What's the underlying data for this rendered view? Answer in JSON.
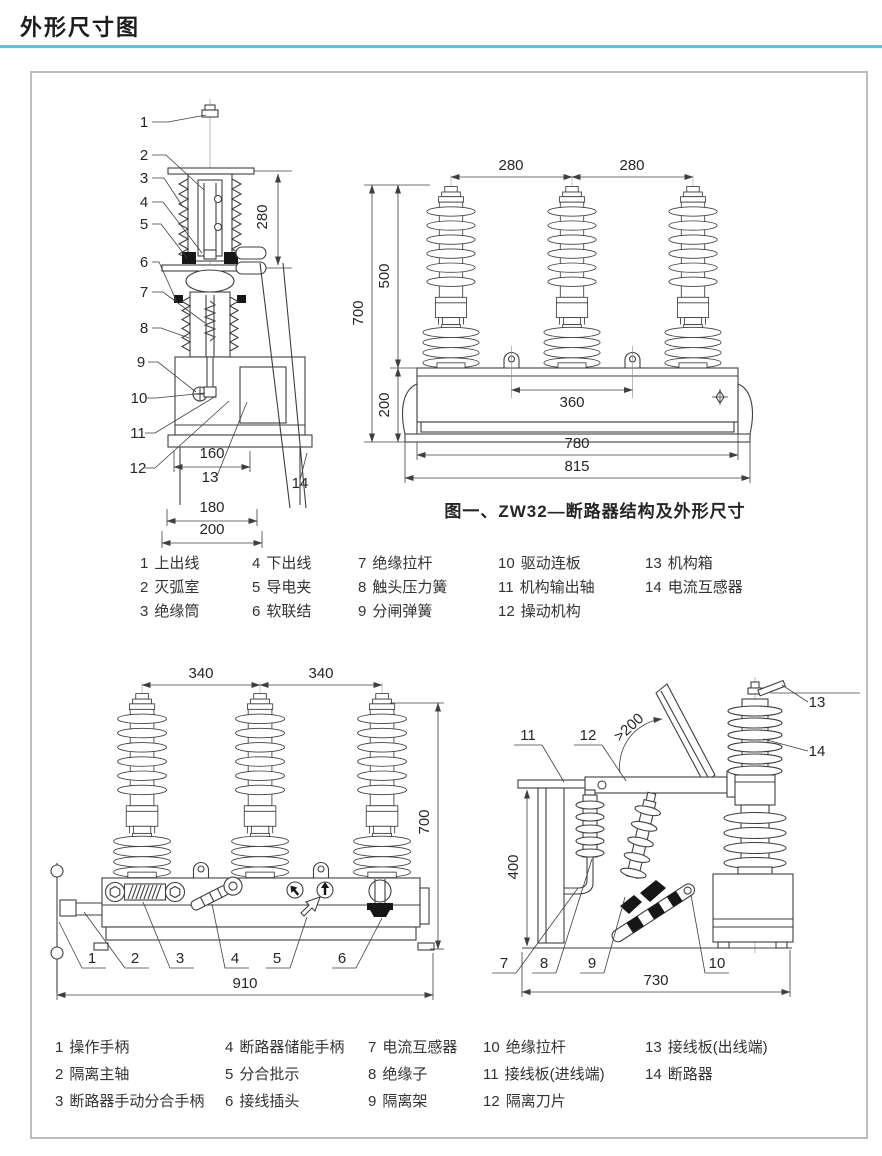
{
  "page": {
    "title": "外形尺寸图"
  },
  "colors": {
    "accent": "#5bc0e8",
    "ink": "#3f3f3f",
    "frame_border": "#bcbcbc"
  },
  "figure1": {
    "caption": "图一、ZW32—断路器结构及外形尺寸",
    "side_view": {
      "callouts": [
        "1",
        "2",
        "3",
        "4",
        "5",
        "6",
        "7",
        "8",
        "9",
        "10",
        "11",
        "12",
        "13",
        "14"
      ],
      "dim_height": "280",
      "dim_w1": "160",
      "dim_w2": "180",
      "dim_w3": "200"
    },
    "front_view": {
      "dim_pitch_left": "280",
      "dim_pitch_right": "280",
      "dim_upper_height": "500",
      "dim_total_height": "700",
      "dim_base_height": "200",
      "dim_lug_spacing": "360",
      "dim_body_width": "780",
      "dim_total_width": "815"
    },
    "legend_columns": [
      [
        {
          "num": "1",
          "label": "上出线"
        },
        {
          "num": "2",
          "label": "灭弧室"
        },
        {
          "num": "3",
          "label": "绝缘筒"
        }
      ],
      [
        {
          "num": "4",
          "label": "下出线"
        },
        {
          "num": "5",
          "label": "导电夹"
        },
        {
          "num": "6",
          "label": "软联结"
        }
      ],
      [
        {
          "num": "7",
          "label": "绝缘拉杆"
        },
        {
          "num": "8",
          "label": "触头压力簧"
        },
        {
          "num": "9",
          "label": "分闸弹簧"
        }
      ],
      [
        {
          "num": "10",
          "label": "驱动连板"
        },
        {
          "num": "11",
          "label": "机构输出轴"
        },
        {
          "num": "12",
          "label": "操动机构"
        }
      ],
      [
        {
          "num": "13",
          "label": "机构箱"
        },
        {
          "num": "14",
          "label": "电流互感器"
        }
      ]
    ]
  },
  "figure2": {
    "front_view": {
      "callouts": [
        "1",
        "2",
        "3",
        "4",
        "5",
        "6"
      ],
      "dim_pitch_left": "340",
      "dim_pitch_right": "340",
      "dim_total_height": "700",
      "dim_total_width": "910"
    },
    "side_view": {
      "callouts_top": [
        "11",
        "12",
        "13",
        "14"
      ],
      "callouts_bottom": [
        "7",
        "8",
        "9",
        "10"
      ],
      "dim_angle": ">200",
      "dim_height": "400",
      "dim_depth": "730"
    },
    "legend_columns": [
      [
        {
          "num": "1",
          "label": "操作手柄"
        },
        {
          "num": "2",
          "label": "隔离主轴"
        },
        {
          "num": "3",
          "label": "断路器手动分合手柄"
        }
      ],
      [
        {
          "num": "4",
          "label": "断路器储能手柄"
        },
        {
          "num": "5",
          "label": "分合批示"
        },
        {
          "num": "6",
          "label": "接线插头"
        }
      ],
      [
        {
          "num": "7",
          "label": "电流互感器"
        },
        {
          "num": "8",
          "label": "绝缘子"
        },
        {
          "num": "9",
          "label": "隔离架"
        }
      ],
      [
        {
          "num": "10",
          "label": "绝缘拉杆"
        },
        {
          "num": "11",
          "label": "接线板(进线端)"
        },
        {
          "num": "12",
          "label": "隔离刀片"
        }
      ],
      [
        {
          "num": "13",
          "label": "接线板(出线端)"
        },
        {
          "num": "14",
          "label": "断路器"
        }
      ]
    ]
  }
}
